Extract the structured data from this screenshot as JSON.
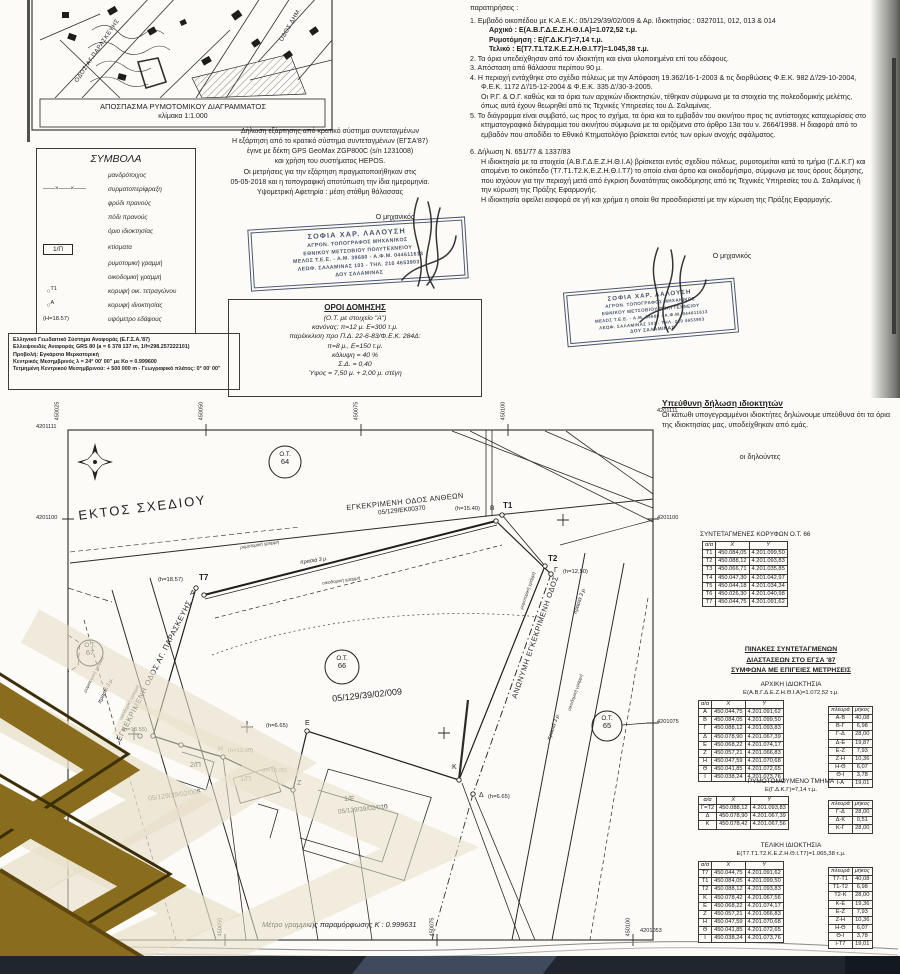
{
  "colors": {
    "paper": "#fcfbf8",
    "ink": "#222222",
    "stamp_ink": "#46546e",
    "watermark_gold": "#8a6c1e",
    "watermark_beige": "#e8e0c9",
    "footer_bar": "#20252e"
  },
  "map_excerpt": {
    "caption1": "ΑΠΟΣΠΑΣΜΑ ΡΥΜΟΤΟΜΙΚΟΥ ΔΙΑΓΡΑΜΜΑΤΟΣ",
    "caption2": "κλίμακα 1:1.000",
    "street1": "ΟΔΟΣ ΑΓ.ΠΑΡΑΣΚΕΥΗΣ",
    "street2": "ΟΔΟΣ ΔΗΜ."
  },
  "symbols": {
    "title": "ΣΥΜΒΟΛΑ",
    "items": [
      {
        "label": "μανδρότοιχος"
      },
      {
        "label": "συρματοπερίφραξη"
      },
      {
        "label": "φρύδι πρανούς"
      },
      {
        "label": "πόδι πρανούς"
      },
      {
        "label": "όριο ιδιοκτησίας"
      },
      {
        "glyph": "1/Π",
        "label": "κτίσματα"
      },
      {
        "label": "ρυμοτομική γραμμή"
      },
      {
        "label": "οικοδομική γραμμή"
      },
      {
        "glyph": "Τ1",
        "label": "κορυφή οικ. τετραγώνου"
      },
      {
        "glyph": "Α",
        "label": "κορυφή ιδιοκτησίας"
      },
      {
        "glyph": "(Η=18.57)",
        "label": "υψόμετρο εδάφους"
      }
    ]
  },
  "gps_declaration": {
    "lines": [
      "Δήλωση εξάρτησης από κρατικό σύστημα συντεταγμένων",
      "Η εξάρτηση από το κρατικό σύστημα συντεταγμένων  (ΕΓΣΑ'87)",
      "έγινε με δέκτη GPS GeoMax ZGP800C (s/n 1231008)",
      "και χρήση του συστήματος HEPOS.",
      "Οι μετρήσεις για την εξάρτηση  πραγματοποιήθηκαν στις",
      "05-05-2018 και η τοπογραφική αποτύπωση την ίδια ημερομηνία.",
      "Υψομετρική Αφετηρία : μέση στάθμη θάλασσας"
    ]
  },
  "engineer_label": "Ο μηχανικός",
  "stamp": {
    "lines": [
      "ΣΟΦΙΑ ΧΑΡ. ΛΑΛΟΥΣΗ",
      "ΑΓΡΟΝ. ΤΟΠΟΓΡΑΦΟΣ ΜΗΧΑΝΙΚΟΣ",
      "ΕΘΝΙΚΟΥ ΜΕΤΣΟΒΙΟΥ ΠΟΛΥΤΕΧΝΕΙΟΥ",
      "ΜΕΛΟΣ Τ.Ε.Ε. - Α.Μ. 39680 - Α.Φ.Μ. 044611613",
      "ΛΕΩΦ. ΣΑΛΑΜΙΝΑΣ 103 - ΤΗΛ. 210 4653903",
      "ΔΟΥ ΣΑΛΑΜΙΝΑΣ"
    ]
  },
  "oroi": {
    "title": "ΟΡΟΙ ΔΟΜΗΣΗΣ",
    "lines": [
      "(Ο.Τ. με στοιχείο \"Α\")",
      "κανόνας: π=12 μ.  Ε=300 τ.μ.",
      "παρέκκλιση προ Π.Δ. 22-6-83/Φ.Ε.Κ. 284Δ:",
      "π=8 μ.,  Ε=150 τ.μ.",
      "κάλυψη = 40 %",
      "Σ.Δ. = 0,40",
      "Ύψος = 7,50 μ. + 2,00 μ. στέγη"
    ]
  },
  "geodetic": {
    "lines": [
      "Ελληνικό Γεωδαιτικό Σύστημα Αναφοράς (Ε.Γ.Σ.Α.'87)",
      "Ελλειψοειδές Αναφοράς GRS 80 (a = 6 378 137 m, 1/f=298.257222101)",
      "Προβολή: Εγκάρσια Μερκατορική",
      "Κεντρικός Μεσημβρινός λ = 24° 00' 00\" με Κο = 0.999600",
      "Τετμημένη Κεντρικού Μεσημβρινού: + 500 000 m - Γεωγραφικό πλάτος: 0° 00' 00\""
    ]
  },
  "notes": {
    "lines": [
      {
        "t": "παρατηρήσεις :",
        "cls": "h"
      },
      {
        "t": "1. Εμβαδό οικοπέδου με Κ.Α.Ε.Κ.: 05/129/39/02/009 & Αρ. Ιδιοκτησίας : 0327011, 012, 013 & 014",
        "cls": "n"
      },
      {
        "t": "Αρχικό : Ε(Α.Β.Γ.Δ.Ε.Ζ.Η.Θ.Ι.Α)=1.072,52 τ.μ.",
        "cls": "s"
      },
      {
        "t": "Ρυμοτόμηση : Ε(Γ.Δ.Κ.Γ)=7,14 τ.μ.",
        "cls": "s"
      },
      {
        "t": "Τελικό : Ε(Τ7.Τ1.Τ2.Κ.Ε.Ζ.Η.Θ.Ι.Τ7)=1.045,38 τ.μ.",
        "cls": "s"
      },
      {
        "t": "2. Τα όρια υπεδείχθησαν από τον ιδιοκτήτη και είναι υλοποιημένα επί του εδάφους.",
        "cls": "n"
      },
      {
        "t": "3. Απόσταση από θάλασσα περίπου 90 μ.",
        "cls": "n"
      },
      {
        "t": "4. Η περιοχή εντάχθηκε στο σχέδιο πόλεως με την Απόφαση 19.362/16-1-2003 & τις διορθώσεις Φ.Ε.Κ. 982 Δ'/29-10-2004, Φ.Ε.Κ. 1172 Δ'/15-12-2004 & Φ.Ε.Κ. 335 Δ'/30-3-2005.",
        "cls": "n"
      },
      {
        "t": "Οι Ρ.Γ. & Ο.Γ. καθώς και τα όρια των αρχικών ιδιοκτησιών, τέθηκαν σύμφωνα με τα στοιχεία της πολεοδομικής μελέτης, όπως αυτά έχουν θεωρηθεί από τις Τεχνικές Υπηρεσίες του Δ. Σαλαμίνας.",
        "cls": "c"
      },
      {
        "t": "5. Το διάγραμμα είναι συμβατό, ως προς το σχήμα, τα όρια και το εμβαδόν του ακινήτου προς τις αντίστοιχες καταχωρίσεις στο κτηματογραφικό διάγραμμα του ακινήτου σύμφωνα με τα οριζόμενα στο άρθρο 13α του ν. 2664/1998. Η διαφορά από το εμβαδόν που αποδίδει το Εθνικό Κτηματολόγιο βρίσκεται εντός των ορίων ανοχής σφάλματος.",
        "cls": "n"
      },
      {
        "t": "6. Δήλωση Ν.  651/77 & 1337/83",
        "cls": "g"
      },
      {
        "t": "Η ιδιοκτησία με τα στοιχεία (Α.Β.Γ.Δ.Ε.Ζ.Η.Θ.Ι.Α) βρίσκεται εντός σχεδίου πόλεως, ρυμοτομείται κατά το τμήμα (Γ.Δ.Κ.Γ) και απομένει το οικόπεδο (Τ7.Τ1.Τ2.Κ.Ε.Ζ.Η.Θ.Ι.Τ7) το οποίο είναι άρτιο και οικοδομήσιμο, σύμφωνα με τους όρους δόμησης, που ισχύουν για την περιοχή μετά από  έγκριση δυνατότητας οικοδόμησης από τις Τεχνικές Υπηρεσίες του Δ. Σαλαμίνας ή την κύρωση της Πράξης Εφαρμογής.",
        "cls": "c"
      },
      {
        "t": "Η ιδιοκτησία οφείλει εισφορά σε γή και χρήμα η οποία θα προσδιοριστεί με την κύρωση της Πράξης Εφαρμογής.",
        "cls": "c"
      }
    ]
  },
  "owners": {
    "title": "Υπεύθυνη δήλωση ιδιοκτητών",
    "body": "Οι κάτωθι υπογεγραμμένοι ιδιοκτήτες δηλώνουμε υπεύθυνα ότι τα όρια της ιδιοκτησίας μας, υποδείχθηκαν από εμάς.",
    "signers": "οι δηλούντες"
  },
  "plan": {
    "labels": {
      "ektos": "ΕΚΤΟΣ ΣΧΕΔΙΟΥ",
      "odos_antheon": "ΕΓΚΕΚΡΙΜΕΝΗ ΟΔΟΣ ΑΝΘΕΩΝ",
      "odos_antheon_code": "05/129/ΕΚ00370",
      "odos_paraskevis": "ΕΓΚΕΚΡΙΜΕΝΗ ΟΔΟΣ ΑΓ. ΠΑΡΑΣΚΕΥΗΣ",
      "odos_anonymi": "ΑΝΩΝΥΜΗ ΕΓΚΕΚΡΙΜΕΝΗ ΟΔΟΣ",
      "kaek_main": "05/129/39/02/009",
      "kaek_006": "05/129/39/02/006",
      "kaek_010": "05/129/39/02/010",
      "parcel_1e": "1/Ε",
      "b1p": "1/Π",
      "b2p": "2/Π",
      "prasia": "πρασιά 3 μ.",
      "rym_line": "ρυμοτομική γραμμή",
      "oik_line": "οικοδομική γραμμή",
      "pt_t7": "Τ7",
      "pt_t7_h": "(h=18.57)",
      "pt_a": "Α",
      "pt_t1": "Τ1",
      "pt_b": "Β",
      "pt_t1_h": "(h=15.40)",
      "pt_t2": "Τ2",
      "pt_g": "Γ",
      "pt_g_h": "(h=12,50)",
      "pt_1855": "(h=18.55)",
      "pt_h": "Η",
      "pt_h_h": "(h=13.90)",
      "pt_1300": "(h=13.00)",
      "pt_z": "Ζ",
      "pt_e": "Ε",
      "pt_e_h": "(h=6.65)",
      "pt_k": "Κ",
      "pt_d": "Δ",
      "pt_d_h": "(h=6.65)"
    },
    "ot": [
      {
        "name": "Ο.Τ.",
        "num": "64"
      },
      {
        "name": "Ο.Τ.",
        "num": "66"
      },
      {
        "name": "Ο.Τ.",
        "num": "65"
      },
      {
        "name": "Ο.Τ.",
        "num": "67"
      }
    ],
    "frame": {
      "top": [
        "450025",
        "450050",
        "450075",
        "450100"
      ],
      "bottom": [
        "450050",
        "450075",
        "450100"
      ],
      "left": [
        "4201111",
        "4201100",
        "4201075",
        "4201053"
      ],
      "right": [
        "4201111",
        "4201100",
        "4201075",
        "4201053"
      ]
    },
    "metro": "Μέτρο γραμμικής παραμόρφωσης Κ : 0.999631"
  },
  "tables": {
    "ot66": {
      "title": "ΣΥΝΤΕΤΑΓΜΕΝΕΣ ΚΟΡΥΦΩΝ Ο.Τ. 66",
      "headers": [
        "α/α",
        "X",
        "Y"
      ],
      "rows": [
        [
          "Τ1",
          "450.084,05",
          "4.201.099,50"
        ],
        [
          "Τ2",
          "450.088,12",
          "4.201.093,83"
        ],
        [
          "Τ3",
          "450.066,71",
          "4.201.035,85"
        ],
        [
          "Τ4",
          "450.047,30",
          "4.201.042,97"
        ],
        [
          "Τ5",
          "450.044,18",
          "4.201.034,34"
        ],
        [
          "Τ6",
          "450.026,30",
          "4.201.040,98"
        ],
        [
          "Τ7",
          "450.044,75",
          "4.201.091,62"
        ]
      ]
    },
    "pinakes_title": {
      "lines": [
        "ΠΙΝΑΚΕΣ ΣΥΝΤΕΤΑΓΜΕΝΩΝ",
        "ΔΙΑΣΤΑΣΕΩΝ ΣΤΟ ΕΓΣΑ '87",
        "ΣΥΜΦΩΝΑ ΜΕ ΕΠΙΓΕΙΕΣ ΜΕΤΡΗΣΕΙΣ"
      ]
    },
    "arxiki": {
      "title": "ΑΡΧΙΚΗ ΙΔΙΟΚΤΗΣΙΑ",
      "area": "Ε(Α.Β.Γ.Δ.Ε.Ζ.Η.Θ.Ι.Α)=1.072,52 τ.μ.",
      "coords": {
        "headers": [
          "α/α",
          "X",
          "Y"
        ],
        "rows": [
          [
            "Α",
            "450.044,75",
            "4.201.091,62"
          ],
          [
            "Β",
            "450.084,05",
            "4.201.099,50"
          ],
          [
            "Γ",
            "450.088,12",
            "4.201.093,83"
          ],
          [
            "Δ",
            "450.078,90",
            "4.201.067,39"
          ],
          [
            "Ε",
            "450.068,22",
            "4.201.074,17"
          ],
          [
            "Ζ",
            "450.057,21",
            "4.201.066,83"
          ],
          [
            "Η",
            "450.047,59",
            "4.201.070,68"
          ],
          [
            "Θ",
            "450.041,85",
            "4.201.072,65"
          ],
          [
            "Ι",
            "450.038,24",
            "4.201.073,76"
          ]
        ]
      },
      "sides": {
        "headers": [
          "πλευρά",
          "μήκος"
        ],
        "rows": [
          [
            "Α-Β",
            "40,08"
          ],
          [
            "Β-Γ",
            "6,98"
          ],
          [
            "Γ-Δ",
            "28,00"
          ],
          [
            "Δ-Ε",
            "19,87"
          ],
          [
            "Ε-Ζ",
            "7,93"
          ],
          [
            "Ζ-Η",
            "10,36"
          ],
          [
            "Η-Θ",
            "6,07"
          ],
          [
            "Θ-Ι",
            "3,78"
          ],
          [
            "Ι-Α",
            "19,01"
          ]
        ]
      }
    },
    "rymotomoymeno": {
      "title": "ΡΥΜΟΤΟΜΟΥΜΕΝΟ ΤΜΗΜΑ",
      "area": "Ε(Γ.Δ.Κ.Γ)=7,14 τ.μ.",
      "coords": {
        "headers": [
          "α/α",
          "X",
          "Y"
        ],
        "rows": [
          [
            "Γ=Τ2",
            "450.088,12",
            "4.201.093,83"
          ],
          [
            "Δ",
            "450.078,90",
            "4.201.067,39"
          ],
          [
            "Κ",
            "450.078,42",
            "4.201.067,56"
          ]
        ]
      },
      "sides": {
        "headers": [
          "πλευρά",
          "μήκος"
        ],
        "rows": [
          [
            "Γ-Δ",
            "28,00"
          ],
          [
            "Δ-Κ",
            "0,51"
          ],
          [
            "Κ-Γ",
            "28,00"
          ]
        ]
      }
    },
    "teliki": {
      "title": "ΤΕΛΙΚΗ ΙΔΙΟΚΤΗΣΙΑ",
      "area": "Ε(Τ7.Τ1.Τ2.Κ.Ε.Ζ.Η.Θ.Ι.Τ7)=1.065,38 τ.μ.",
      "coords": {
        "headers": [
          "α/α",
          "X",
          "Y"
        ],
        "rows": [
          [
            "Τ7",
            "450.044,75",
            "4.201.091,62"
          ],
          [
            "Τ1",
            "450.084,05",
            "4.201.099,50"
          ],
          [
            "Τ2",
            "450.088,12",
            "4.201.093,83"
          ],
          [
            "Κ",
            "450.078,42",
            "4.201.067,56"
          ],
          [
            "Ε",
            "450.068,22",
            "4.201.074,17"
          ],
          [
            "Ζ",
            "450.057,21",
            "4.201.066,83"
          ],
          [
            "Η",
            "450.047,59",
            "4.201.070,68"
          ],
          [
            "Θ",
            "450.041,85",
            "4.201.072,65"
          ],
          [
            "Ι",
            "450.038,24",
            "4.201.073,76"
          ]
        ]
      },
      "sides": {
        "headers": [
          "πλευρά",
          "μήκος"
        ],
        "rows": [
          [
            "Τ7-Τ1",
            "40,08"
          ],
          [
            "Τ1-Τ2",
            "6,98"
          ],
          [
            "Τ2-Κ",
            "28,00"
          ],
          [
            "Κ-Ε",
            "19,36"
          ],
          [
            "Ε-Ζ",
            "7,93"
          ],
          [
            "Ζ-Η",
            "10,36"
          ],
          [
            "Η-Θ",
            "6,07"
          ],
          [
            "Θ-Ι",
            "3,78"
          ],
          [
            "Ι-Τ7",
            "19,01"
          ]
        ]
      }
    }
  }
}
